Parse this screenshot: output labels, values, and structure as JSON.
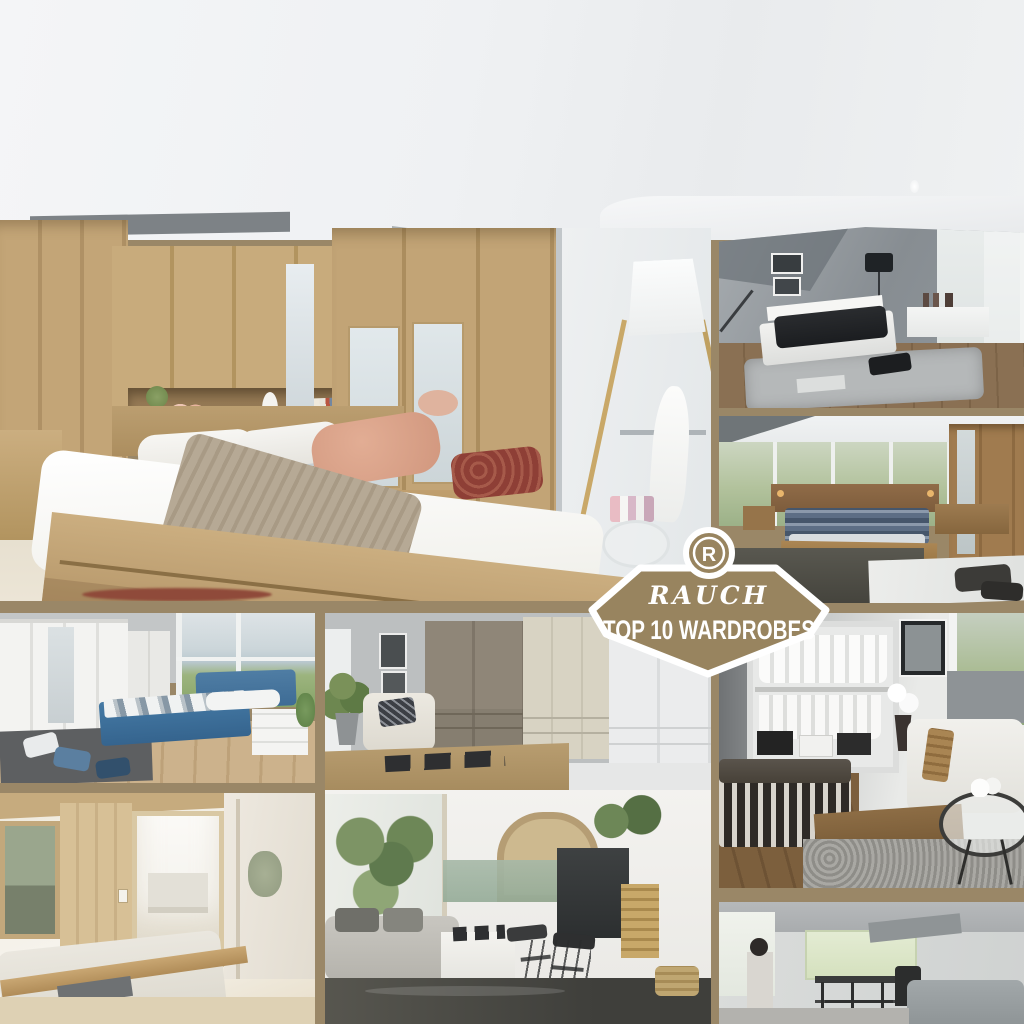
{
  "badge": {
    "monogram": "R",
    "brand": "RAUCH",
    "title": "TOP 10 WARDROBES"
  },
  "colors": {
    "frame_tan": "#9a8767",
    "badge_fill": "#98845f",
    "badge_border": "#ffffff",
    "badge_text": "#ffffff",
    "ceiling_white": "#f2f3f5"
  },
  "collage": {
    "tiles": [
      {
        "id": "main",
        "description": "Large oak bedroom with overbed wardrobe bridge, mirrored wardrobe doors, double bed with salmon and red pillows, tripod floor lamp"
      },
      {
        "id": "top-right",
        "description": "Modern grey bedroom with white bed, dark bedding and black floor lamp"
      },
      {
        "id": "mid-right",
        "description": "Solid wood bed in front of panoramic garden window with sliding wardrobe"
      },
      {
        "id": "mid-left",
        "description": "White wardrobe wall and blue upholstered box-spring bed with lake view window"
      },
      {
        "id": "mid-center",
        "description": "Corner wardrobe group in taupe, cream and white with armchair and plant"
      },
      {
        "id": "right-walkin",
        "description": "Walk-in open wardrobe with hanging shirts, white sofa, glass side table and striped bench"
      },
      {
        "id": "bottom-left",
        "description": "Pale oak bedroom with framed landscape artwork"
      },
      {
        "id": "bottom-center",
        "description": "Living area with large plants, stone arch, dark fireplace and log store"
      },
      {
        "id": "bottom-right",
        "description": "Open-plan modern room with pale green cabinet, dining set and grey sofa"
      }
    ]
  }
}
